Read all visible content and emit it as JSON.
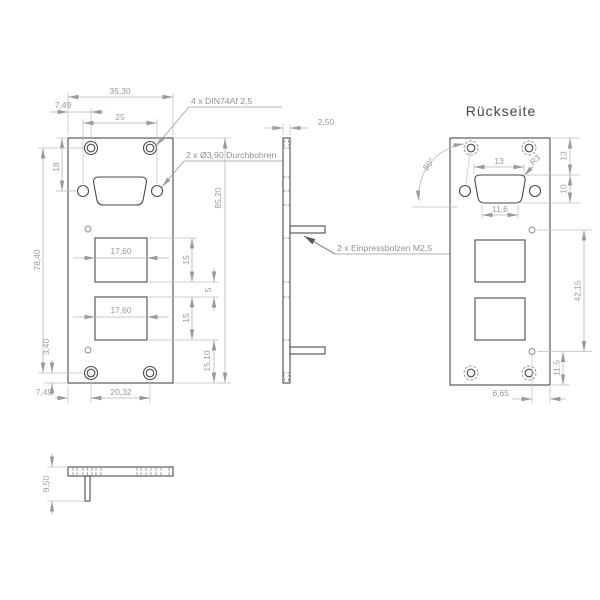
{
  "front_view": {
    "width_total": "35,30",
    "edge_to_hole_top": "7,49",
    "dsub_hole_spacing": "25",
    "countersink_label": "4 x DIN74Af 2,5",
    "through_hole_label": "2 x Ø3,90 Durchbohren",
    "top_to_dsub_axis": "18",
    "hole_rows_spacing": "78,40",
    "total_height": "85,20",
    "rect_width_upper": "17,60",
    "rect_width_lower": "17,60",
    "rect_height_upper": "15",
    "rect_gap": "5",
    "rect_height_lower": "15",
    "rect_to_bottom": "15,10",
    "hole_to_bottom": "3,40",
    "edge_to_hole_bottom": "7,49",
    "bottom_hole_spacing": "20,32"
  },
  "side_view": {
    "thickness": "2,50",
    "studs_label": "2 x Einpressbolzen M2,5"
  },
  "back_view": {
    "title": "Rückseite",
    "dsub_top_width": "13",
    "dsub_bottom_width": "11,6",
    "corner_radius": "R3",
    "angle": "80°",
    "top_edge_to_dsub": "13",
    "dsub_height": "10",
    "stud_spacing": "42,15",
    "stud_to_bottom": "11,5",
    "stud_to_edge": "6,65"
  },
  "bottom_view": {
    "overall_height": "9,50"
  },
  "colors": {
    "edge": "#4a4a4f",
    "dim_line": "#b5b5b5",
    "dim_text": "#9a9a9a",
    "hidden_line": "#8a8a8f",
    "title_text": "#45454b"
  }
}
